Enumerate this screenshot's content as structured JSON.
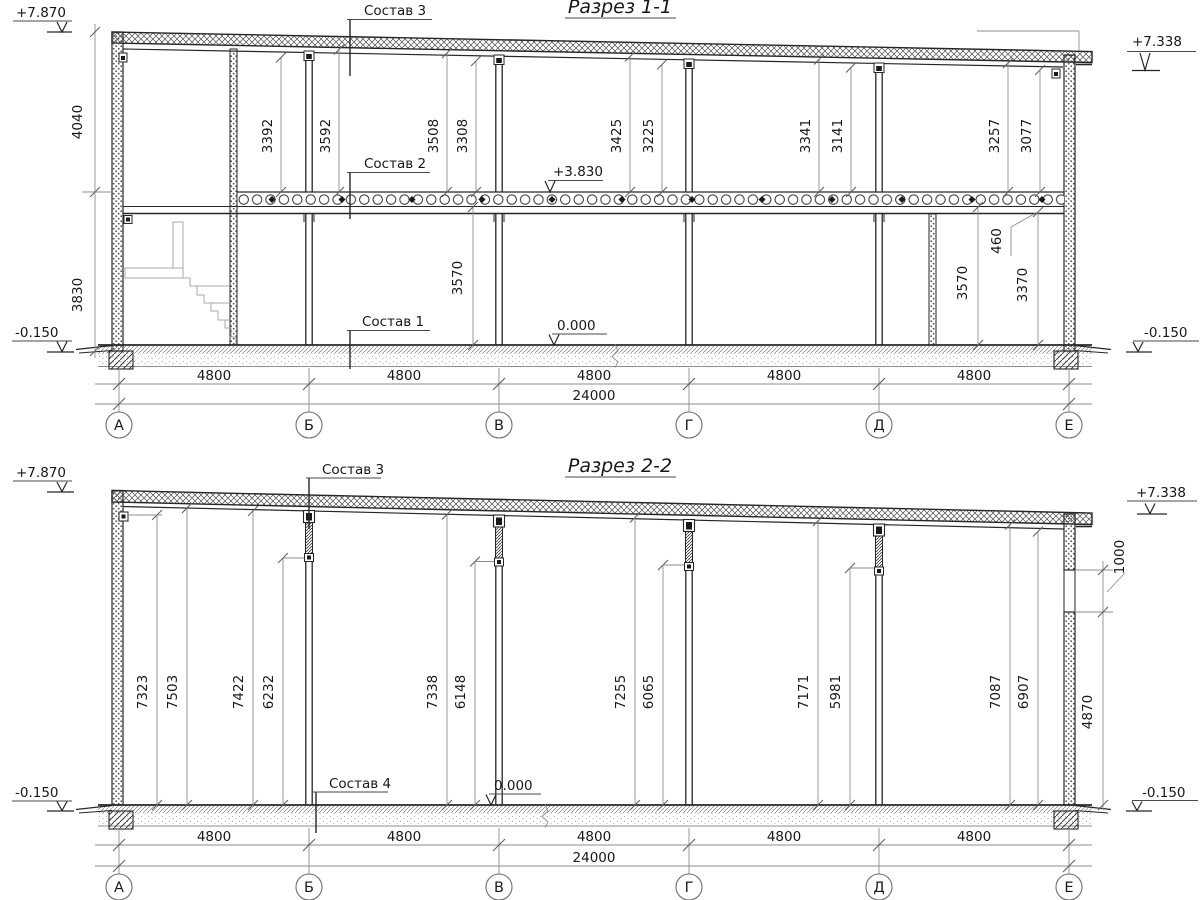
{
  "s1": {
    "title": "Разрез 1-1",
    "labels": [
      "Состав 3",
      "Состав 2",
      "Состав 1"
    ],
    "elevations": {
      "top_left": "+7.870",
      "top_right": "+7.338",
      "bottom_left": "-0.150",
      "bottom_right": "-0.150",
      "ground": "0.000",
      "slab": "+3.830"
    },
    "left_dims": [
      "4040",
      "3830"
    ],
    "upper_dims": [
      "3392",
      "3592",
      "3508",
      "3308",
      "3425",
      "3225",
      "3341",
      "3141",
      "3257",
      "3077"
    ],
    "floor_dims": [
      "3570",
      "3570",
      "3370"
    ],
    "beam_dim": "460",
    "spans": [
      "4800",
      "4800",
      "4800",
      "4800",
      "4800"
    ],
    "total_span": "24000",
    "axes": [
      "А",
      "Б",
      "В",
      "Г",
      "Д",
      "Е"
    ]
  },
  "s2": {
    "title": "Разрез 2-2",
    "labels": [
      "Состав 3",
      "Состав 4"
    ],
    "elevations": {
      "top_left": "+7.870",
      "top_right": "+7.338",
      "bottom_left": "-0.150",
      "bottom_right": "-0.150",
      "ground": "0.000"
    },
    "height_dims": [
      "7323",
      "7503",
      "7422",
      "6232",
      "7338",
      "6148",
      "7255",
      "6065",
      "7171",
      "5981",
      "7087",
      "6907"
    ],
    "right_dims": [
      "1000",
      "4870"
    ],
    "spans": [
      "4800",
      "4800",
      "4800",
      "4800",
      "4800"
    ],
    "total_span": "24000",
    "axes": [
      "А",
      "Б",
      "В",
      "Г",
      "Д",
      "Е"
    ]
  }
}
